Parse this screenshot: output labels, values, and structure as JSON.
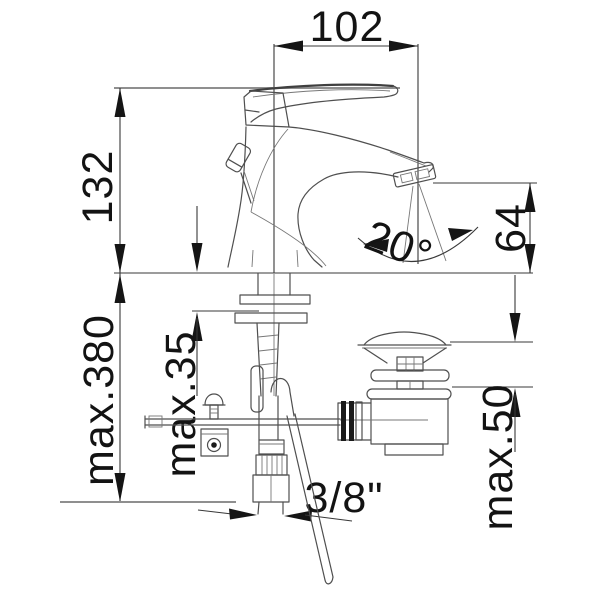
{
  "dimensions": {
    "spout_reach": "102",
    "spout_height": "132",
    "outlet_to_deck": "64",
    "spray_angle": "20°",
    "hose_max_length": "max.380",
    "deck_max_thickness": "max.35",
    "drain_deck_max_thickness": "max.50",
    "supply_connection": "3/8\""
  },
  "colors": {
    "background": "#ffffff",
    "drawing_line": "#4f4f4f",
    "dimension_line": "#383838",
    "text": "#131313"
  }
}
